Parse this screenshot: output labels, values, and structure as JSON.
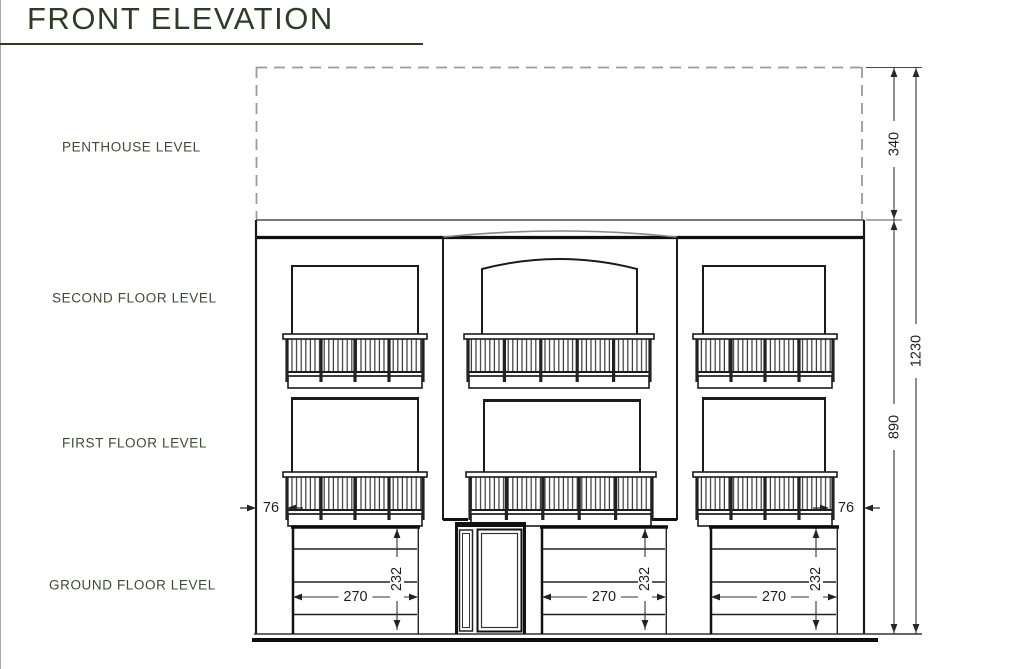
{
  "title": "FRONT ELEVATION",
  "floor_labels": {
    "penthouse": "PENTHOUSE LEVEL",
    "second": "SECOND FLOOR LEVEL",
    "first": "FIRST FLOOR LEVEL",
    "ground": "GROUND FLOOR LEVEL"
  },
  "dimensions": {
    "penthouse_height": "340",
    "main_height": "890",
    "total_height": "1230",
    "side_offset": "76",
    "garage_width": "270",
    "garage_height": "232"
  },
  "colors": {
    "heading_green": "#2e3c26",
    "line_ink": "#1b1b1b",
    "dashed_gray": "#9b9b9b"
  }
}
